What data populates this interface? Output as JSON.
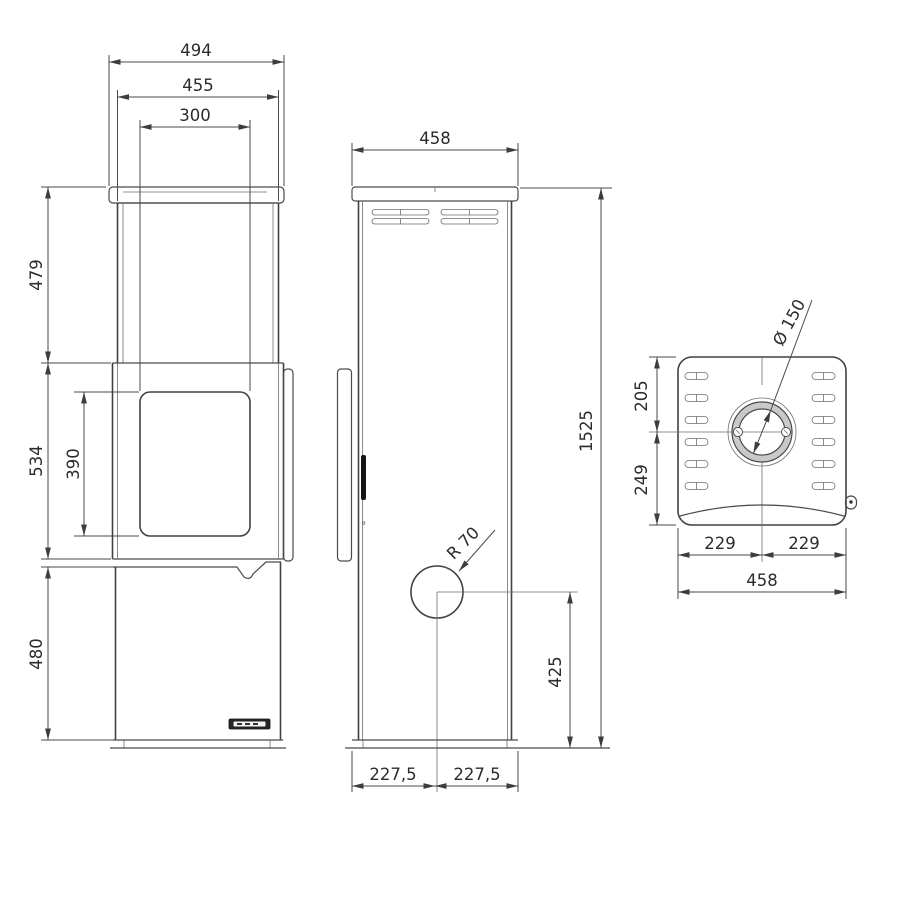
{
  "front": {
    "cap_width": "494",
    "body_width": "455",
    "window_width": "300",
    "upper_height": "479",
    "middle_height": "534",
    "window_height": "390",
    "lower_height": "480",
    "brand_badge_icon": "brand-logo-badge"
  },
  "side": {
    "depth": "458",
    "total_height": "1525",
    "flue_radius": "R 70",
    "flue_center_height": "425",
    "front_half_depth": "227,5",
    "rear_half_depth": "227,5"
  },
  "top": {
    "flue_diameter": "Ø 150",
    "rear_to_flue_center": "205",
    "flue_center_to_front": "249",
    "left_half_width": "229",
    "right_half_width": "229",
    "total_width": "458"
  },
  "colors": {
    "line": "#474747",
    "text": "#2b2b2b",
    "background": "#ffffff"
  }
}
